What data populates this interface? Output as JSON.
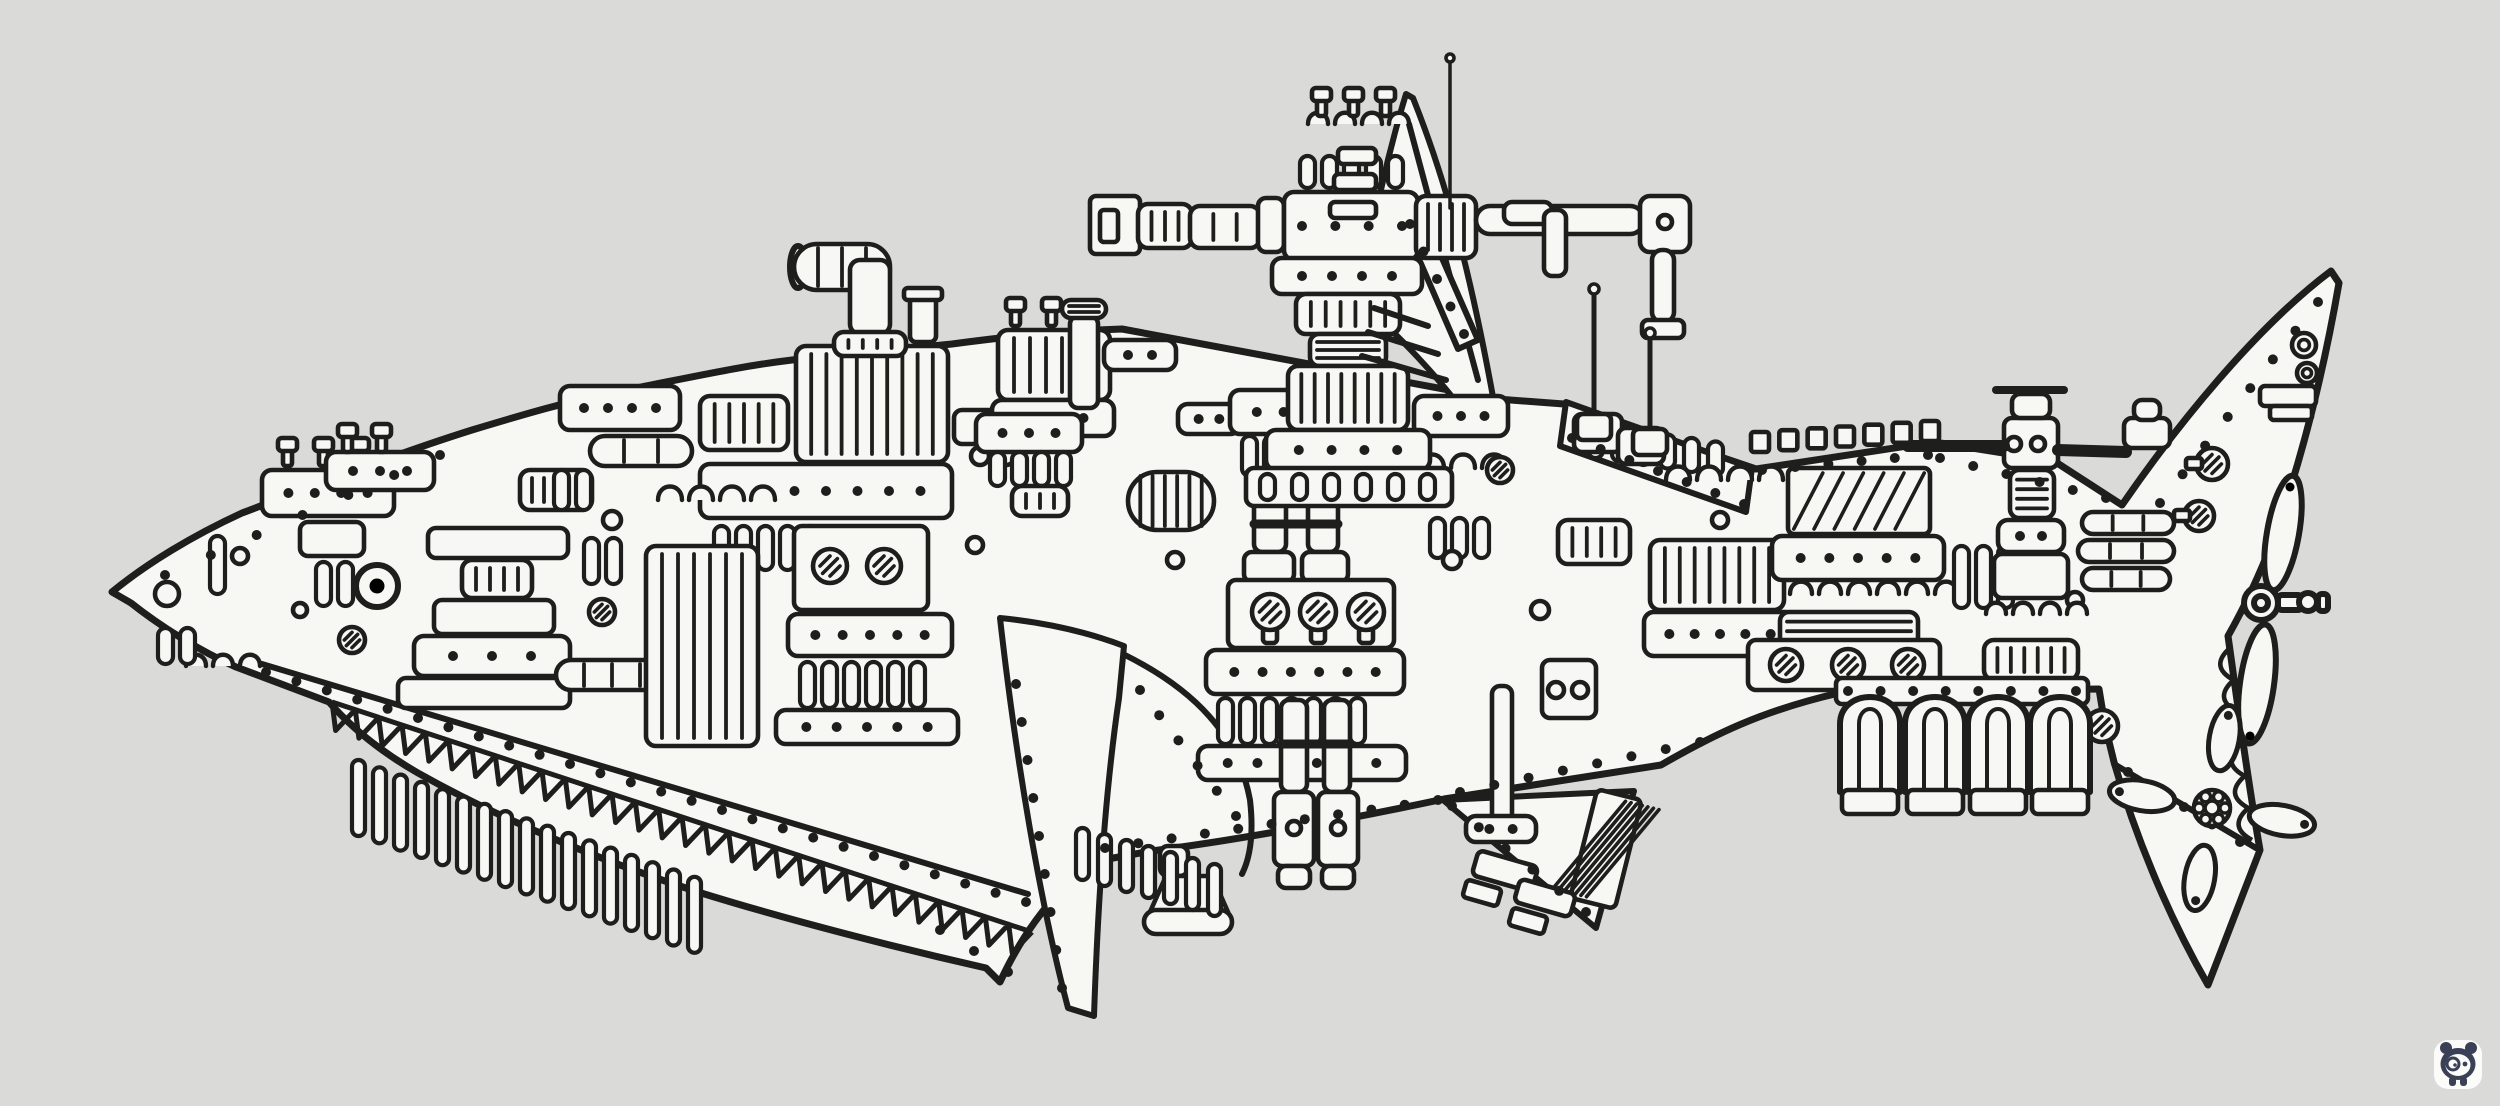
{
  "artwork": {
    "subject": "mechanical-shark-ink-drawing",
    "style": "steampunk machinery assembled into a shark silhouette, black ink on white paper",
    "parts": [
      "snout",
      "eye",
      "mouth-teeth",
      "jaw-vent-slots",
      "smokestack-pipe",
      "deck-engines",
      "gun-turret",
      "dorsal-fin",
      "antenna-masts",
      "mid-hull-machinery",
      "pectoral-fin-blade",
      "belly-plate",
      "piston-legs",
      "bell-thruster",
      "keel-rod",
      "pelvic-fin",
      "exhaust-pipes",
      "aft-machinery",
      "castellated-deck",
      "tail-fin-upper",
      "two-blade-propeller",
      "tail-fin-lower",
      "four-blade-propeller"
    ]
  },
  "palette": {
    "paper": "#f0f0ed",
    "paper_bright": "#f7f7f4",
    "ink": "#1e1e1c",
    "watermark_navy": "#3a4156",
    "sticker_white": "#fbfbf9"
  },
  "watermark": {
    "name": "panda-logo",
    "x": 2458,
    "y": 1064
  },
  "teeth": [
    332,
    702,
    1032,
    932,
    30,
    26
  ],
  "mouth_band": [
    262,
    664,
    1028,
    894
  ],
  "castellation": [
    1760,
    452,
    1930,
    441,
    7,
    18,
    20
  ],
  "scallops": [
    2230,
    648,
    2252,
    840,
    6,
    11
  ],
  "exhausts": {
    "xs": [
      1870,
      1935,
      1998,
      2060
    ],
    "top": 694,
    "bottom": 792,
    "half": 30,
    "inner": 11,
    "foot_h": 24
  },
  "prop4": {
    "cx": 2212,
    "cy": 808,
    "dist": 46,
    "len": 66,
    "wid": 30,
    "rot": 10,
    "hub": 18
  },
  "antennas": [
    [
      1594,
      289,
      434,
      5,
      5,
      1
    ],
    [
      1650,
      333,
      449,
      5,
      5,
      1
    ],
    [
      1450,
      58,
      208,
      4,
      3.5,
      0
    ]
  ],
  "rivet_lines": [
    [
      266,
      672,
      1026,
      902,
      26,
      5
    ],
    [
      165,
      575,
      440,
      455,
      7,
      5
    ],
    [
      1105,
      848,
      1438,
      800,
      11,
      5
    ],
    [
      1460,
      792,
      1700,
      742,
      8,
      5
    ],
    [
      1016,
      684,
      1062,
      988,
      9,
      5
    ],
    [
      1140,
      690,
      1236,
      816,
      6,
      5
    ],
    [
      2160,
      503,
      2318,
      302,
      8,
      5
    ],
    [
      1572,
      438,
      1744,
      504,
      7,
      5
    ],
    [
      1762,
      470,
      1928,
      455,
      6,
      5
    ],
    [
      1940,
      458,
      2106,
      498,
      6,
      5
    ],
    [
      1452,
      806,
      1586,
      912,
      6,
      5
    ],
    [
      2128,
      772,
      2240,
      842,
      5,
      5
    ],
    [
      940,
      930,
      1008,
      972,
      3,
      5
    ],
    [
      1302,
      226,
      1402,
      226,
      4,
      5
    ],
    [
      1410,
      224,
      1464,
      334,
      5,
      5
    ],
    [
      1848,
      691,
      2076,
      691,
      8,
      5
    ]
  ],
  "greebles": [
    [
      "hole",
      167,
      594,
      12
    ],
    [
      "slots",
      210,
      536,
      1,
      58
    ],
    [
      "rivets",
      262,
      470,
      132,
      46,
      4
    ],
    [
      "bolts",
      278,
      438,
      3,
      36
    ],
    [
      "box",
      300,
      522,
      64,
      34
    ],
    [
      "slots",
      316,
      562,
      2,
      44
    ],
    [
      "box",
      428,
      528,
      140,
      30
    ],
    [
      "ribs",
      462,
      560,
      70,
      38,
      4
    ],
    [
      "box",
      434,
      600,
      120,
      34
    ],
    [
      "rivets",
      414,
      636,
      156,
      40,
      3
    ],
    [
      "box",
      398,
      678,
      172,
      30
    ],
    [
      "screw",
      352,
      640,
      13
    ],
    [
      "arches",
      186,
      666,
      3,
      10
    ],
    [
      "slots",
      158,
      628,
      2,
      36
    ],
    [
      "hole",
      300,
      610,
      7
    ],
    [
      "ribs",
      520,
      470,
      72,
      40,
      5
    ],
    [
      "slots",
      584,
      538,
      2,
      46
    ],
    [
      "screw",
      602,
      612,
      13
    ],
    [
      "pill",
      556,
      660,
      112,
      30,
      3
    ],
    [
      "rivets",
      326,
      452,
      108,
      38,
      3
    ],
    [
      "bolts",
      338,
      424,
      2,
      34
    ],
    [
      "hole",
      240,
      556,
      8
    ],
    [
      "rivets",
      560,
      386,
      120,
      44,
      4
    ],
    [
      "ribs",
      700,
      396,
      88,
      54,
      5
    ],
    [
      "ribs",
      796,
      346,
      152,
      116,
      9
    ],
    [
      "rivets",
      700,
      464,
      252,
      54,
      7
    ],
    [
      "slots",
      714,
      526,
      5,
      44
    ],
    [
      "box",
      794,
      526,
      134,
      84
    ],
    [
      "screw",
      830,
      566,
      17
    ],
    [
      "screw",
      884,
      566,
      17
    ],
    [
      "rivets",
      788,
      614,
      164,
      42,
      5
    ],
    [
      "slots",
      800,
      662,
      6,
      46
    ],
    [
      "rivets",
      776,
      710,
      182,
      34,
      5
    ],
    [
      "ribs",
      646,
      546,
      112,
      200,
      6
    ],
    [
      "arches",
      658,
      500,
      4,
      12
    ],
    [
      "pill",
      590,
      436,
      102,
      30,
      2
    ],
    [
      "slots",
      554,
      470,
      2,
      40
    ],
    [
      "box",
      954,
      410,
      54,
      34
    ],
    [
      "holes",
      980,
      456,
      2,
      26,
      9
    ],
    [
      "bolts",
      1006,
      298,
      2,
      36
    ],
    [
      "ribs",
      998,
      330,
      112,
      70,
      6
    ],
    [
      "rivets",
      992,
      400,
      122,
      36,
      3
    ],
    [
      "box",
      1070,
      316,
      28,
      92
    ],
    [
      "hlines",
      1062,
      300,
      44,
      18,
      2
    ],
    [
      "rivets",
      1104,
      340,
      72,
      30,
      2
    ],
    [
      "hole",
      612,
      520,
      9
    ],
    [
      "hole",
      975,
      545,
      8
    ],
    [
      "pill",
      794,
      244,
      96,
      46,
      3
    ],
    [
      "box",
      850,
      260,
      40,
      74,
      10
    ],
    [
      "ribs",
      834,
      332,
      72,
      24,
      4
    ],
    [
      "box",
      910,
      296,
      26,
      46,
      6
    ],
    [
      "box",
      904,
      288,
      38,
      12,
      4
    ],
    [
      "rivets",
      976,
      414,
      106,
      38,
      3
    ],
    [
      "slots",
      990,
      452,
      4,
      34
    ],
    [
      "ribs",
      1012,
      486,
      56,
      30,
      3
    ],
    [
      "pill",
      1128,
      472,
      86,
      58,
      6
    ],
    [
      "rivets",
      1178,
      404,
      62,
      30,
      2
    ],
    [
      "rivets",
      1230,
      390,
      134,
      44,
      4
    ],
    [
      "slots",
      1242,
      436,
      5,
      40
    ],
    [
      "box",
      1254,
      496,
      32,
      56
    ],
    [
      "box",
      1308,
      496,
      30,
      56
    ],
    [
      "bar",
      1254,
      524,
      1338,
      524,
      9
    ],
    [
      "box",
      1244,
      552,
      50,
      30
    ],
    [
      "box",
      1302,
      552,
      46,
      30
    ],
    [
      "box",
      1228,
      580,
      166,
      68
    ],
    [
      "screw",
      1270,
      612,
      18,
      1
    ],
    [
      "screw",
      1318,
      612,
      18,
      1
    ],
    [
      "screw",
      1366,
      612,
      18,
      1
    ],
    [
      "rivets",
      1206,
      650,
      198,
      44,
      6
    ],
    [
      "slots",
      1218,
      698,
      7,
      46
    ],
    [
      "rivets",
      1198,
      746,
      208,
      34,
      6
    ],
    [
      "arches",
      1420,
      468,
      3,
      12
    ],
    [
      "rivets",
      1414,
      396,
      94,
      40,
      3
    ],
    [
      "slots",
      1430,
      518,
      3,
      40
    ],
    [
      "box",
      1542,
      660,
      54,
      58
    ],
    [
      "holes",
      1556,
      690,
      2,
      24,
      8
    ],
    [
      "hole",
      1452,
      560,
      9
    ],
    [
      "screw",
      1500,
      470,
      13
    ],
    [
      "hole",
      1175,
      560,
      8
    ],
    [
      "box",
      1492,
      686,
      20,
      138
    ],
    [
      "rivets",
      1466,
      816,
      70,
      26,
      2
    ],
    [
      "box",
      1281,
      700,
      26,
      92
    ],
    [
      "box",
      1324,
      700,
      26,
      92
    ],
    [
      "bar",
      1281,
      744,
      1350,
      744,
      9
    ],
    [
      "box",
      1274,
      792,
      40,
      74
    ],
    [
      "box",
      1318,
      792,
      40,
      74
    ],
    [
      "hole",
      1294,
      828,
      7
    ],
    [
      "hole",
      1338,
      828,
      7
    ],
    [
      "box",
      1278,
      866,
      32,
      22
    ],
    [
      "box",
      1322,
      866,
      32,
      22
    ],
    [
      "box",
      1160,
      846,
      28,
      30
    ],
    [
      "trap",
      1150,
      876,
      78,
      46,
      36
    ],
    [
      "pill",
      1144,
      910,
      88,
      24,
      0
    ],
    [
      "slots",
      1076,
      828,
      7,
      52,
      22,
      6,
      13
    ],
    [
      "slots",
      1588,
      424,
      6,
      34,
      24,
      3.5
    ],
    [
      "ribs",
      1558,
      520,
      72,
      44,
      4
    ],
    [
      "arches",
      1666,
      480,
      4,
      12
    ],
    [
      "ribs",
      1650,
      540,
      134,
      70,
      8
    ],
    [
      "rivets",
      1644,
      612,
      152,
      44,
      5
    ],
    [
      "hatch",
      1788,
      468,
      142,
      66,
      6
    ],
    [
      "rivets",
      1772,
      536,
      172,
      44,
      5
    ],
    [
      "arches",
      1790,
      594,
      6,
      11
    ],
    [
      "hlines",
      1780,
      612,
      138,
      48,
      4
    ],
    [
      "box",
      1748,
      640,
      192,
      50
    ],
    [
      "screw",
      1786,
      665,
      16
    ],
    [
      "screw",
      1848,
      665,
      16
    ],
    [
      "screw",
      1908,
      665,
      16
    ],
    [
      "slots",
      1954,
      546,
      3,
      62
    ],
    [
      "hole",
      1720,
      520,
      8
    ],
    [
      "hole",
      2075,
      600,
      8
    ],
    [
      "box",
      2004,
      418,
      54,
      50
    ],
    [
      "holes",
      2014,
      444,
      2,
      24,
      7
    ],
    [
      "box",
      2012,
      394,
      38,
      24
    ],
    [
      "bar",
      1996,
      390,
      2064,
      390,
      8
    ],
    [
      "bar",
      1908,
      446,
      2004,
      446,
      12
    ],
    [
      "bar",
      2058,
      450,
      2126,
      452,
      12
    ],
    [
      "hlines",
      2010,
      470,
      44,
      48,
      4
    ],
    [
      "rivets",
      1998,
      520,
      66,
      32,
      2
    ],
    [
      "box",
      1994,
      554,
      74,
      44
    ],
    [
      "arches",
      1986,
      614,
      4,
      10
    ],
    [
      "ribs",
      1984,
      640,
      94,
      40,
      6
    ],
    [
      "box",
      2124,
      418,
      46,
      30
    ],
    [
      "box",
      2134,
      400,
      26,
      20
    ],
    [
      "pill",
      2082,
      512,
      92,
      22,
      2
    ],
    [
      "pill",
      2078,
      540,
      96,
      22,
      2
    ],
    [
      "pill",
      2082,
      568,
      88,
      22,
      2
    ],
    [
      "screw",
      2102,
      726,
      16
    ],
    [
      "box",
      1836,
      678,
      252,
      26,
      6
    ],
    [
      "box",
      1090,
      196,
      50,
      58,
      6
    ],
    [
      "box",
      1100,
      210,
      18,
      32,
      4
    ],
    [
      "ribs",
      1138,
      204,
      54,
      44,
      3
    ],
    [
      "ribs",
      1190,
      206,
      70,
      42,
      2
    ],
    [
      "box",
      1258,
      198,
      26,
      54
    ],
    [
      "box",
      1284,
      192,
      134,
      68,
      10
    ],
    [
      "ribs",
      1416,
      196,
      60,
      62,
      4
    ],
    [
      "pill",
      1476,
      206,
      168,
      28,
      0
    ],
    [
      "box",
      1640,
      196,
      50,
      56,
      10
    ],
    [
      "hole",
      1665,
      222,
      7
    ],
    [
      "box",
      1652,
      250,
      22,
      72,
      10
    ],
    [
      "box",
      1642,
      320,
      42,
      18,
      6
    ],
    [
      "slots",
      1300,
      156,
      5,
      32
    ],
    [
      "arches",
      1308,
      124,
      4,
      10
    ],
    [
      "bolts",
      1312,
      88,
      3,
      32
    ],
    [
      "rivets",
      1272,
      258,
      150,
      36,
      4
    ],
    [
      "ribs",
      1296,
      294,
      104,
      40,
      6
    ],
    [
      "hlines",
      1310,
      334,
      76,
      32,
      3
    ],
    [
      "ribs",
      1288,
      366,
      120,
      64,
      8
    ],
    [
      "rivets",
      1266,
      430,
      164,
      40,
      4
    ],
    [
      "box",
      1246,
      468,
      206,
      38
    ],
    [
      "slots",
      1260,
      474,
      6,
      26,
      32
    ],
    [
      "box",
      1338,
      148,
      38,
      16,
      5
    ],
    [
      "box",
      1334,
      174,
      42,
      16,
      5
    ],
    [
      "box",
      1330,
      202,
      46,
      16,
      5
    ],
    [
      "bar",
      1374,
      308,
      1428,
      326,
      6
    ],
    [
      "bar",
      1368,
      332,
      1438,
      354,
      6
    ],
    [
      "bar",
      1362,
      356,
      1446,
      380,
      6
    ],
    [
      "box",
      1504,
      202,
      48,
      22,
      8
    ],
    [
      "box",
      1544,
      210,
      22,
      66,
      8
    ],
    [
      "box",
      1574,
      414,
      48,
      38
    ],
    [
      "box",
      1618,
      428,
      46,
      36
    ],
    [
      "hole",
      1540,
      610,
      9
    ],
    [
      "hatch",
      1583,
      793,
      46,
      112,
      7,
      14
    ],
    [
      "box",
      1474,
      858,
      62,
      26,
      6,
      16
    ],
    [
      "box",
      1516,
      886,
      58,
      24,
      6,
      16
    ],
    [
      "box",
      1464,
      884,
      36,
      18,
      4,
      16
    ],
    [
      "box",
      1510,
      912,
      36,
      18,
      4,
      16
    ],
    [
      "grommet",
      2304,
      345,
      12
    ],
    [
      "grommet",
      2307,
      373,
      10
    ],
    [
      "screw",
      2212,
      464,
      16
    ],
    [
      "screw",
      2199,
      516,
      15
    ],
    [
      "box",
      2186,
      458,
      16,
      11,
      3
    ],
    [
      "box",
      2174,
      510,
      16,
      11,
      3
    ],
    [
      "box",
      2260,
      386,
      56,
      20,
      5
    ],
    [
      "box",
      2270,
      406,
      42,
      14,
      4
    ]
  ]
}
